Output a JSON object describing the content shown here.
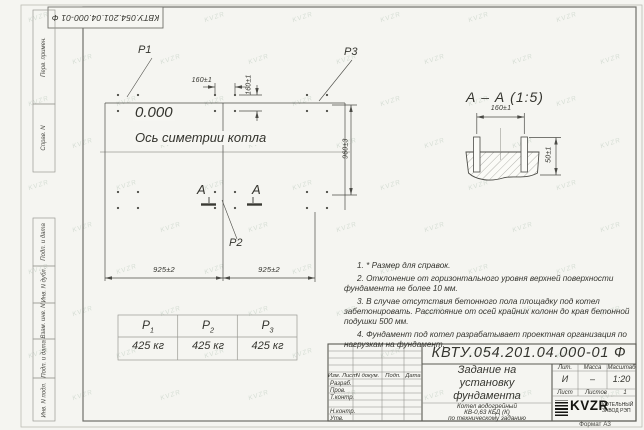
{
  "watermark": {
    "text": "KVZR"
  },
  "margin_labels": [
    "Перв. примен.",
    "Справ. N",
    "Подп. и дата",
    "Инв. N дубл.",
    "Взам. инв. N",
    "Подп. и дата",
    "Инв. N подл."
  ],
  "plan": {
    "p1": "P1",
    "p2": "P2",
    "p3": "P3",
    "elevation": "0.000",
    "axis_label": "Ось симетрии котла",
    "section_letter": "А",
    "dim_160_h": "160±1",
    "dim_160_v": "160±1",
    "dim_960": "960±3",
    "dim_925_left": "925±2",
    "dim_925_right": "925±2"
  },
  "section_view": {
    "title": "А – А (1:5)",
    "dim_160": "160±1",
    "dim_50": "50±1"
  },
  "notes": [
    "1. * Размер для справок.",
    "2. Отклонение от горизонтального уровня верхней поверхности фундамента не более 10 мм.",
    "3. В случае отсутствия бетонного пола площадку под котел забетонировать. Расстояние от осей крайних колонн до края бетонной подушки 500 мм.",
    "4. Фундамент под котел разрабатывает проектная организация по нагрузкам на фундамент."
  ],
  "load_table": {
    "columns": [
      {
        "letter": "P",
        "sub": "1",
        "value": "425 кг"
      },
      {
        "letter": "P",
        "sub": "2",
        "value": "425 кг"
      },
      {
        "letter": "P",
        "sub": "3",
        "value": "425 кг"
      }
    ]
  },
  "title_block": {
    "doc_number": "КВТУ.054.201.04.000-01 Ф",
    "title_lines": [
      "Задание на",
      "установку",
      "фундамента"
    ],
    "product_lines": [
      "Котел водогрейный",
      "КВ-0,63 КБД (К)",
      "по техническому заданию"
    ],
    "rev_headers": [
      "Изм. Лист",
      "N докум.",
      "Подп.",
      "Дата"
    ],
    "sign_labels": [
      "Разраб.",
      "Пров.",
      "Т.контр.",
      "Н.контр.",
      "Утв."
    ],
    "lit_headers": [
      "Лит.",
      "Масса",
      "Масштаб"
    ],
    "lit_values": [
      "И",
      "–",
      "1:20"
    ],
    "sheet_labels": {
      "list": "Лист",
      "listov": "Листов",
      "listov_value": "1"
    },
    "logo": {
      "brand": "KVZR",
      "caption_lines": [
        "КОТЕЛЬНЫЙ",
        "ЗАВОД РЭП"
      ]
    },
    "format_label": "Формат А3"
  }
}
